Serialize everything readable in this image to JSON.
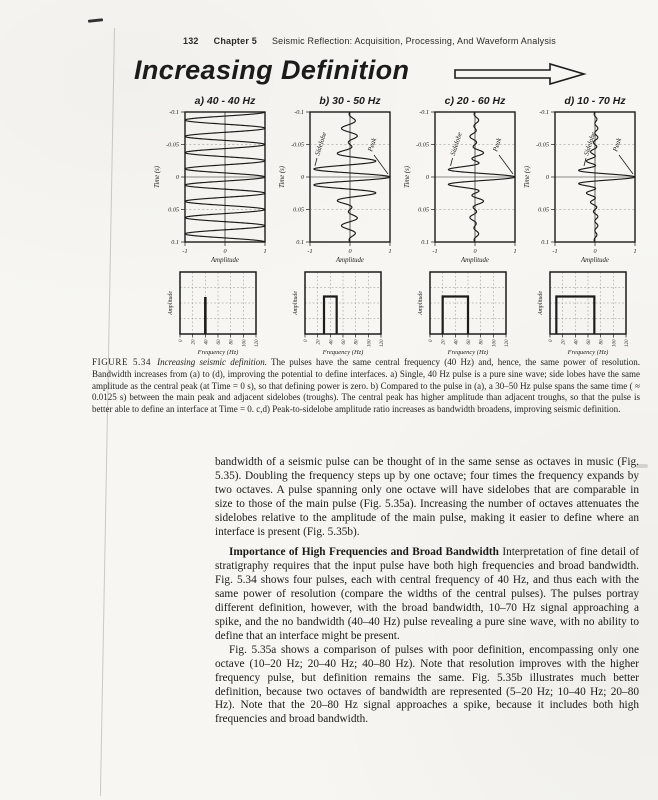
{
  "header": {
    "page_number": "132",
    "chapter": "Chapter 5",
    "title": "Seismic Reflection: Acquisition, Processing, And Waveform Analysis"
  },
  "figure": {
    "banner": "Increasing Definition",
    "caption_label": "FIGURE 5.34",
    "caption_title": "Increasing seismic definition.",
    "caption_body": "The pulses have the same central frequency (40 Hz) and, hence, the same power of resolution. Bandwidth increases from (a) to (d), improving the potential to define interfaces. a) Single, 40 Hz pulse is a pure sine wave; side lobes have the same amplitude as the central peak (at Time = 0 s), so that defining power is zero. b) Compared to the pulse in (a), a 30–50 Hz pulse spans the same time ( ≈ 0.0125 s) between the main peak and adjacent sidelobes (troughs). The central peak has higher amplitude than adjacent troughs, so that the pulse is better able to define an interface at Time = 0. c,d) Peak-to-sidelobe amplitude ratio increases as bandwidth broadens, improving seismic definition."
  },
  "body": {
    "para1": "bandwidth of a seismic pulse can be thought of in the same sense as octaves in music (Fig. 5.35). Doubling the frequency steps up by one octave; four times the frequency expands by two octaves. A pulse spanning only one octave will have sidelobes that are comparable in size to those of the main pulse (Fig. 5.35a). Increasing the number of octaves attenuates the sidelobes relative to the amplitude of the main pulse, making it easier to define where an interface is present (Fig. 5.35b).",
    "heading": "Importance of High Frequencies and Broad Bandwidth",
    "para2": " Interpretation of fine detail of stratigraphy requires that the input pulse have both high frequencies and broad bandwidth. Fig. 5.34 shows four pulses, each with central frequency of 40 Hz, and thus each with the same power of resolution (compare the widths of the central pulses). The pulses portray different definition, however, with the broad bandwidth, 10–70 Hz signal approaching a spike, and the no bandwidth (40–40 Hz) pulse revealing a pure sine wave, with no ability to define that an interface might be present.",
    "para3": "Fig. 5.35a shows a comparison of pulses with poor definition, encompassing only one octave (10–20 Hz; 20–40 Hz; 40–80 Hz). Note that resolution improves with the higher frequency pulse, but definition remains the same. Fig. 5.35b illustrates much better definition, because two octaves of bandwidth are represented (5–20 Hz; 10–40 Hz; 20–80 Hz). Note that the 20–80 Hz signal approaches a spike, because it includes both high frequencies and broad bandwidth."
  },
  "chart_data": [
    {
      "type": "line",
      "title": "Seismic pulses, equal central frequency (40 Hz), increasing bandwidth",
      "xlabel": "Amplitude",
      "ylabel": "Time (s)",
      "xlim": [
        -1,
        1
      ],
      "ylim": [
        -0.1,
        0.1
      ],
      "xticks": [
        "-1",
        "0",
        "1"
      ],
      "yticks": [
        "-0.1",
        "-0.05",
        "0",
        "0.05",
        "0.1"
      ],
      "panels": [
        {
          "label": "a) 40 - 40 Hz",
          "band_hz": [
            40,
            40
          ],
          "annotations": []
        },
        {
          "label": "b) 30 - 50 Hz",
          "band_hz": [
            30,
            50
          ],
          "annotations": [
            "Sidelobe",
            "Peak"
          ]
        },
        {
          "label": "c) 20 - 60 Hz",
          "band_hz": [
            20,
            60
          ],
          "annotations": [
            "Sidelobe",
            "Peak"
          ]
        },
        {
          "label": "d) 10 - 70 Hz",
          "band_hz": [
            10,
            70
          ],
          "annotations": [
            "Sidelobe",
            "Peak"
          ]
        }
      ]
    },
    {
      "type": "area",
      "title": "Amplitude spectra of the four pulses",
      "xlabel": "Frequency (Hz)",
      "ylabel": "Amplitude",
      "xlim": [
        0,
        120
      ],
      "xticks": [
        "0",
        "20",
        "40",
        "60",
        "80",
        "100",
        "120"
      ],
      "panels": [
        {
          "band_hz": [
            40,
            40
          ],
          "shape": "spike"
        },
        {
          "band_hz": [
            30,
            50
          ],
          "shape": "boxcar"
        },
        {
          "band_hz": [
            20,
            60
          ],
          "shape": "boxcar"
        },
        {
          "band_hz": [
            10,
            70
          ],
          "shape": "boxcar"
        }
      ]
    }
  ]
}
